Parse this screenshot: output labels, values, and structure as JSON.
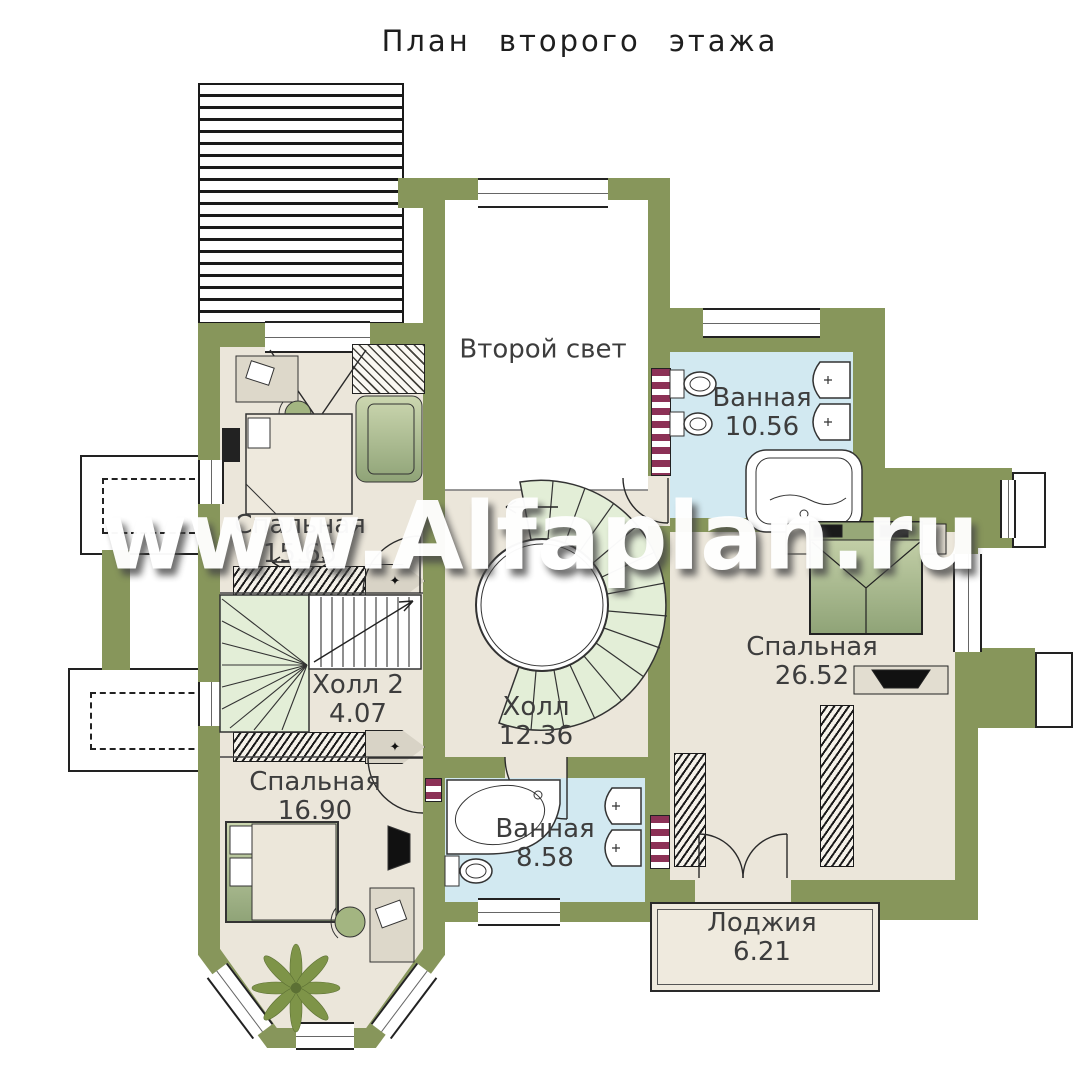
{
  "title": "План второго этажа",
  "watermark": "www.Alfaplan.ru",
  "rooms": [
    {
      "name": "Второй свет",
      "area": ""
    },
    {
      "name": "Ванная",
      "area": "10.56"
    },
    {
      "name": "Спальная",
      "area": "15.65"
    },
    {
      "name": "Холл 2",
      "area": "4.07"
    },
    {
      "name": "Холл",
      "area": "12.36"
    },
    {
      "name": "Спальная",
      "area": "26.52"
    },
    {
      "name": "Спальная",
      "area": "16.90"
    },
    {
      "name": "Ванная",
      "area": "8.58"
    },
    {
      "name": "Лоджия",
      "area": "6.21"
    }
  ],
  "icons": {
    "diamond": "✦"
  },
  "colors": {
    "wall": "#87965b",
    "room_floor": "#ebe6da",
    "bath_floor": "#d2e9f1",
    "stair": "#e3eed7",
    "shaft": "#8c3156",
    "furniture": "#a9bb87",
    "line": "#2a2a2a",
    "watermark": "#ffffff"
  }
}
